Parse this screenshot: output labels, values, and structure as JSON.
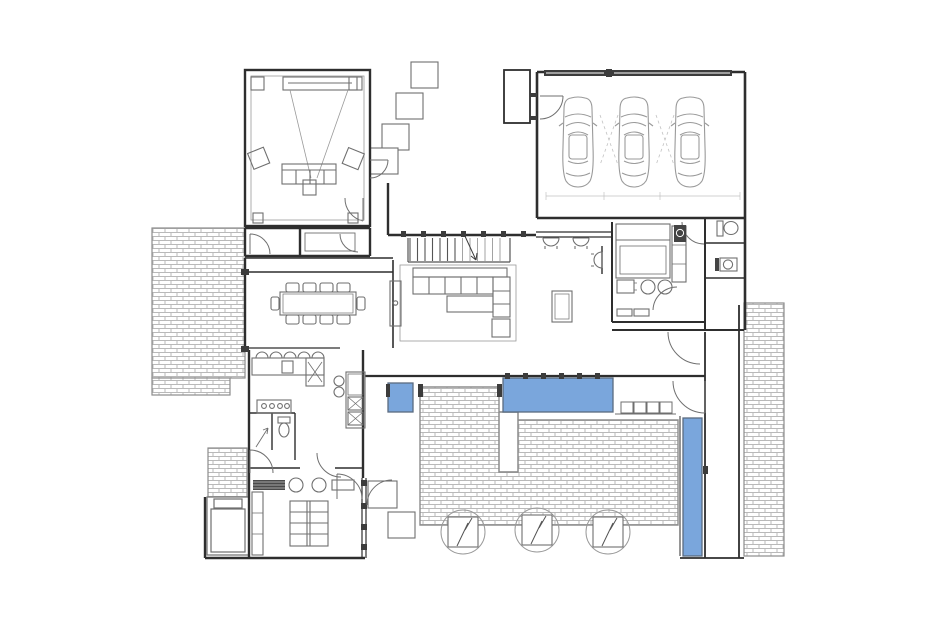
{
  "colors": {
    "background": "#ffffff",
    "wall": "#2e2e2e",
    "inner_wall": "#555555",
    "furniture_line": "#6f6f6f",
    "light_line": "#9a9a9a",
    "brick_line": "#b9b9b9",
    "brick_border": "#8d8d8d",
    "pool_water": "#7aa6dc",
    "pool_edge": "#5a6b80",
    "dark_fixture": "#3c3c3c",
    "guide_line": "#c2c2c2"
  },
  "depicted": {
    "drawing": "ground-floor architectural plan with pool terrace",
    "garage_cars": 3,
    "garage_doors": 2,
    "dining_chairs": 10,
    "kitchen_island_stools": 5,
    "theater_speakers": 6,
    "pool_water_segments": 3,
    "patio_trees": 3,
    "entry_stepping_stones": 4,
    "rear_stepping_stones": 2,
    "pool_bench_cushions": 4,
    "stair_treads": 13
  }
}
